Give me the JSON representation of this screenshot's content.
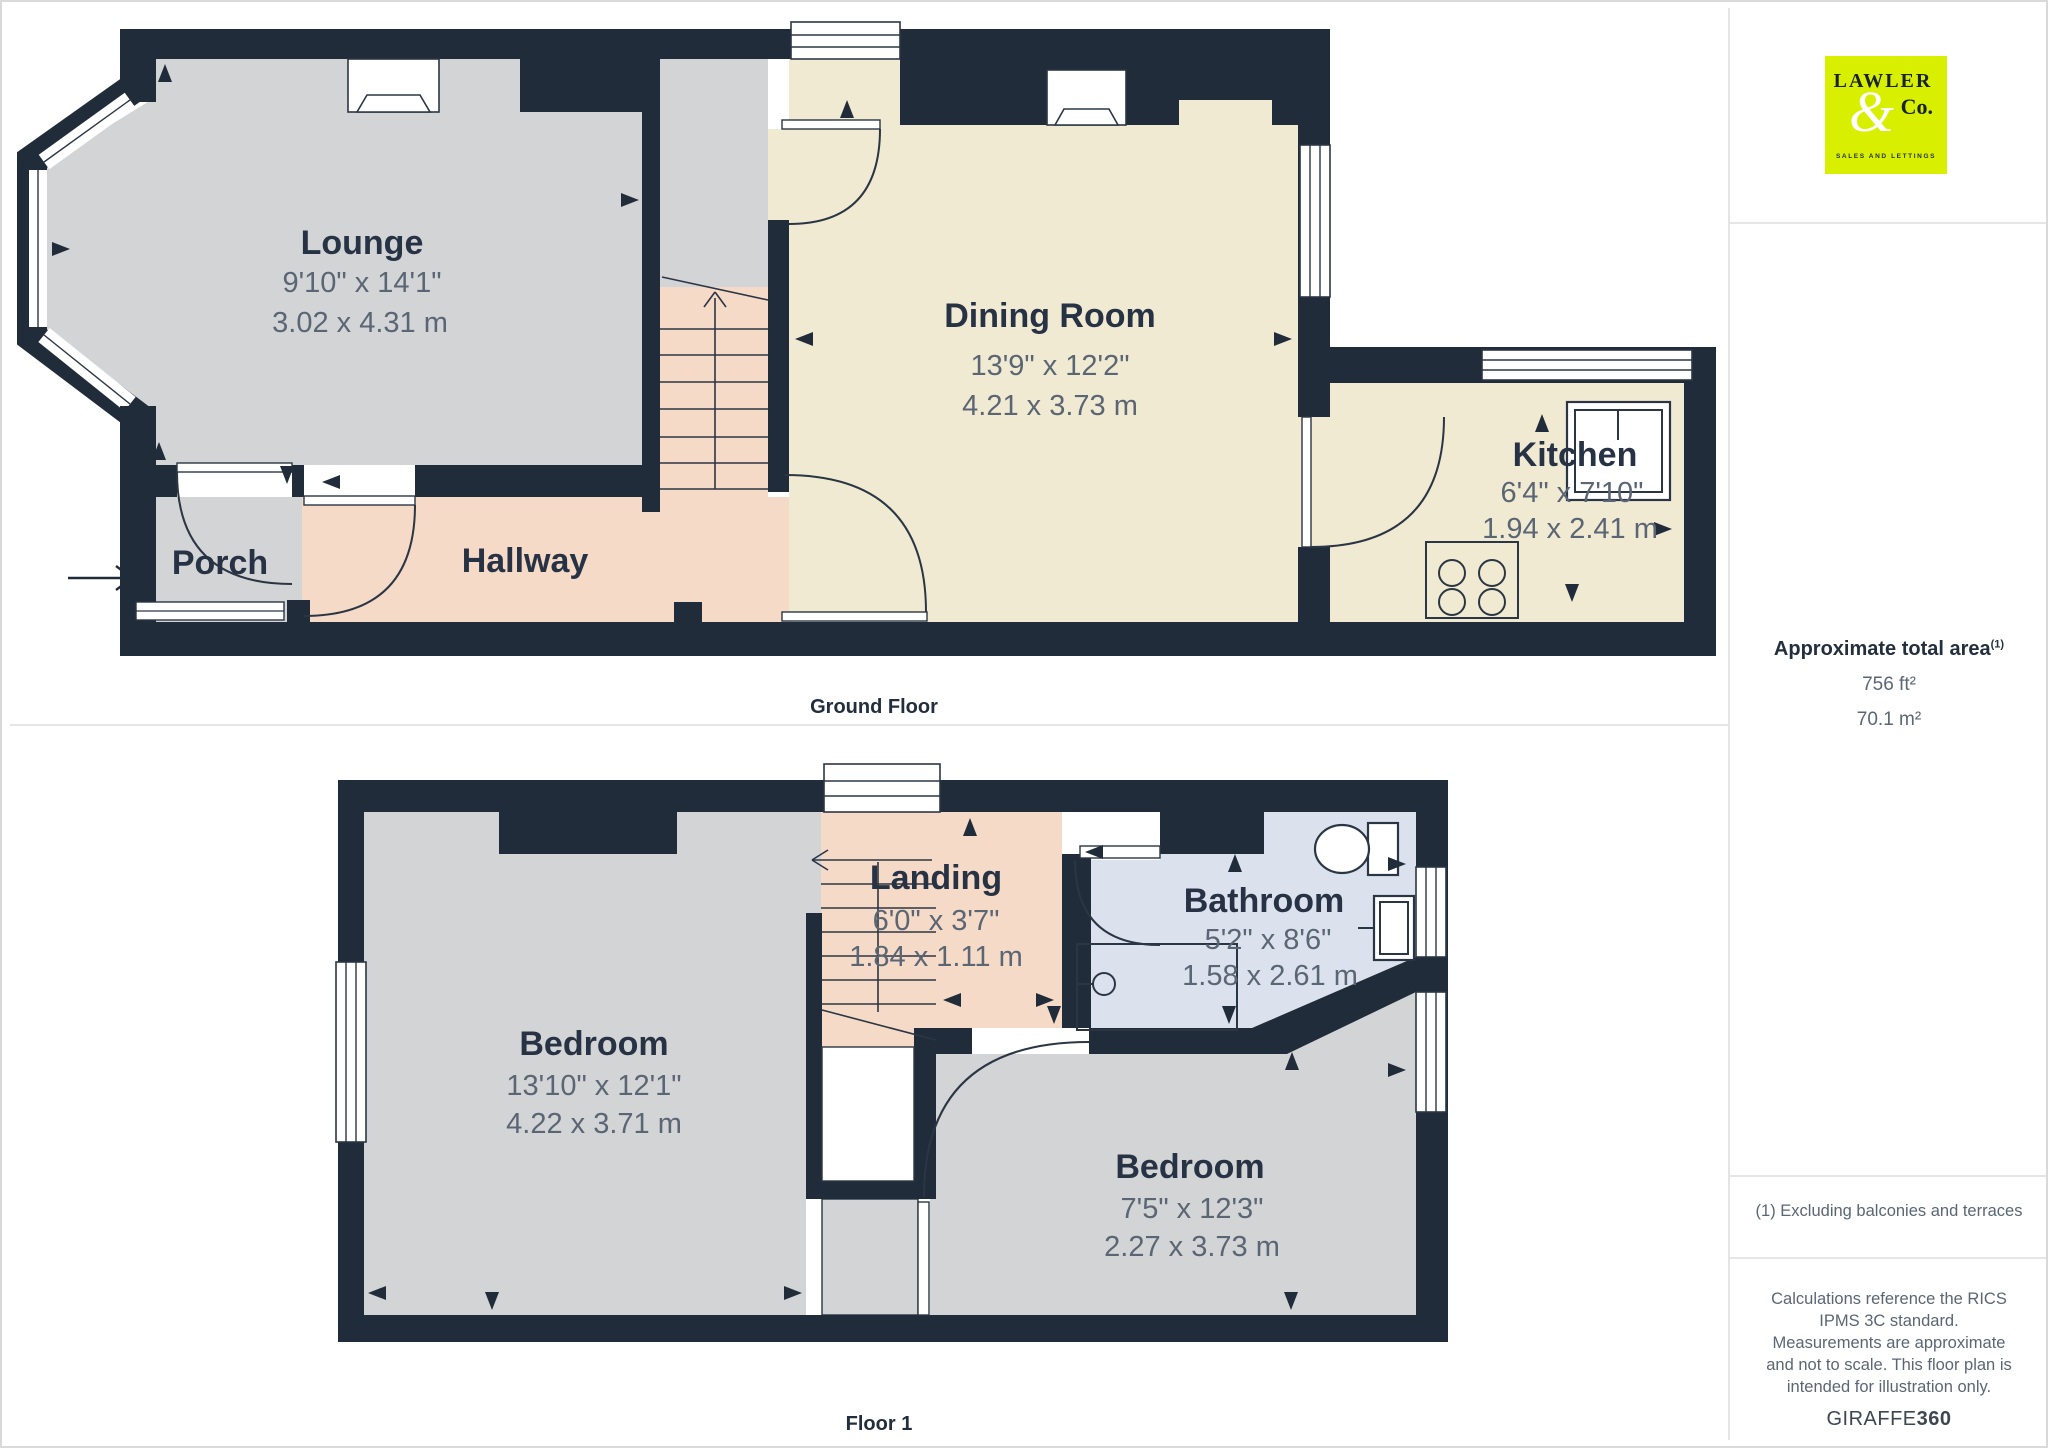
{
  "branding": {
    "logo_line1": "LAWLER",
    "logo_amp": "&",
    "logo_line2": "Co.",
    "logo_tagline": "SALES AND LETTINGS"
  },
  "sidebar": {
    "area_title": "Approximate total area",
    "area_marker": "(1)",
    "area_ft": "756 ft²",
    "area_m": "70.1 m²",
    "footnote": "(1) Excluding balconies and terraces",
    "disclaimer": "Calculations reference the RICS IPMS 3C standard. Measurements are approximate and not to scale. This floor plan is intended for illustration only.",
    "brand_name": "GIRAFFE",
    "brand_suffix": "360"
  },
  "colors": {
    "wall": "#212C3A",
    "floor_gray": "#D3D4D5",
    "floor_cream": "#F1EAD3",
    "floor_salmon": "#F6DAC8",
    "floor_blue": "#DCE1EE",
    "logo_bg": "#D8F000",
    "label_text": "#273344",
    "dim_text": "#5B6674"
  },
  "floors": {
    "ground": {
      "caption": "Ground Floor",
      "rooms": [
        {
          "name": "Lounge",
          "imperial": "9'10\" x 14'1\"",
          "metric": "3.02 x 4.31 m"
        },
        {
          "name": "Dining Room",
          "imperial": "13'9\" x 12'2\"",
          "metric": "4.21 x 3.73 m"
        },
        {
          "name": "Kitchen",
          "imperial": "6'4\" x 7'10\"",
          "metric": "1.94 x 2.41 m"
        },
        {
          "name": "Porch",
          "imperial": "",
          "metric": ""
        },
        {
          "name": "Hallway",
          "imperial": "",
          "metric": ""
        }
      ]
    },
    "first": {
      "caption": "Floor 1",
      "rooms": [
        {
          "name": "Landing",
          "imperial": "6'0\" x 3'7\"",
          "metric": "1.84 x 1.11 m"
        },
        {
          "name": "Bathroom",
          "imperial": "5'2\" x 8'6\"",
          "metric": "1.58 x 2.61 m"
        },
        {
          "name": "Bedroom",
          "imperial": "13'10\" x 12'1\"",
          "metric": "4.22 x 3.71 m"
        },
        {
          "name": "Bedroom",
          "imperial": "7'5\" x 12'3\"",
          "metric": "2.27 x 3.73 m"
        }
      ]
    }
  }
}
